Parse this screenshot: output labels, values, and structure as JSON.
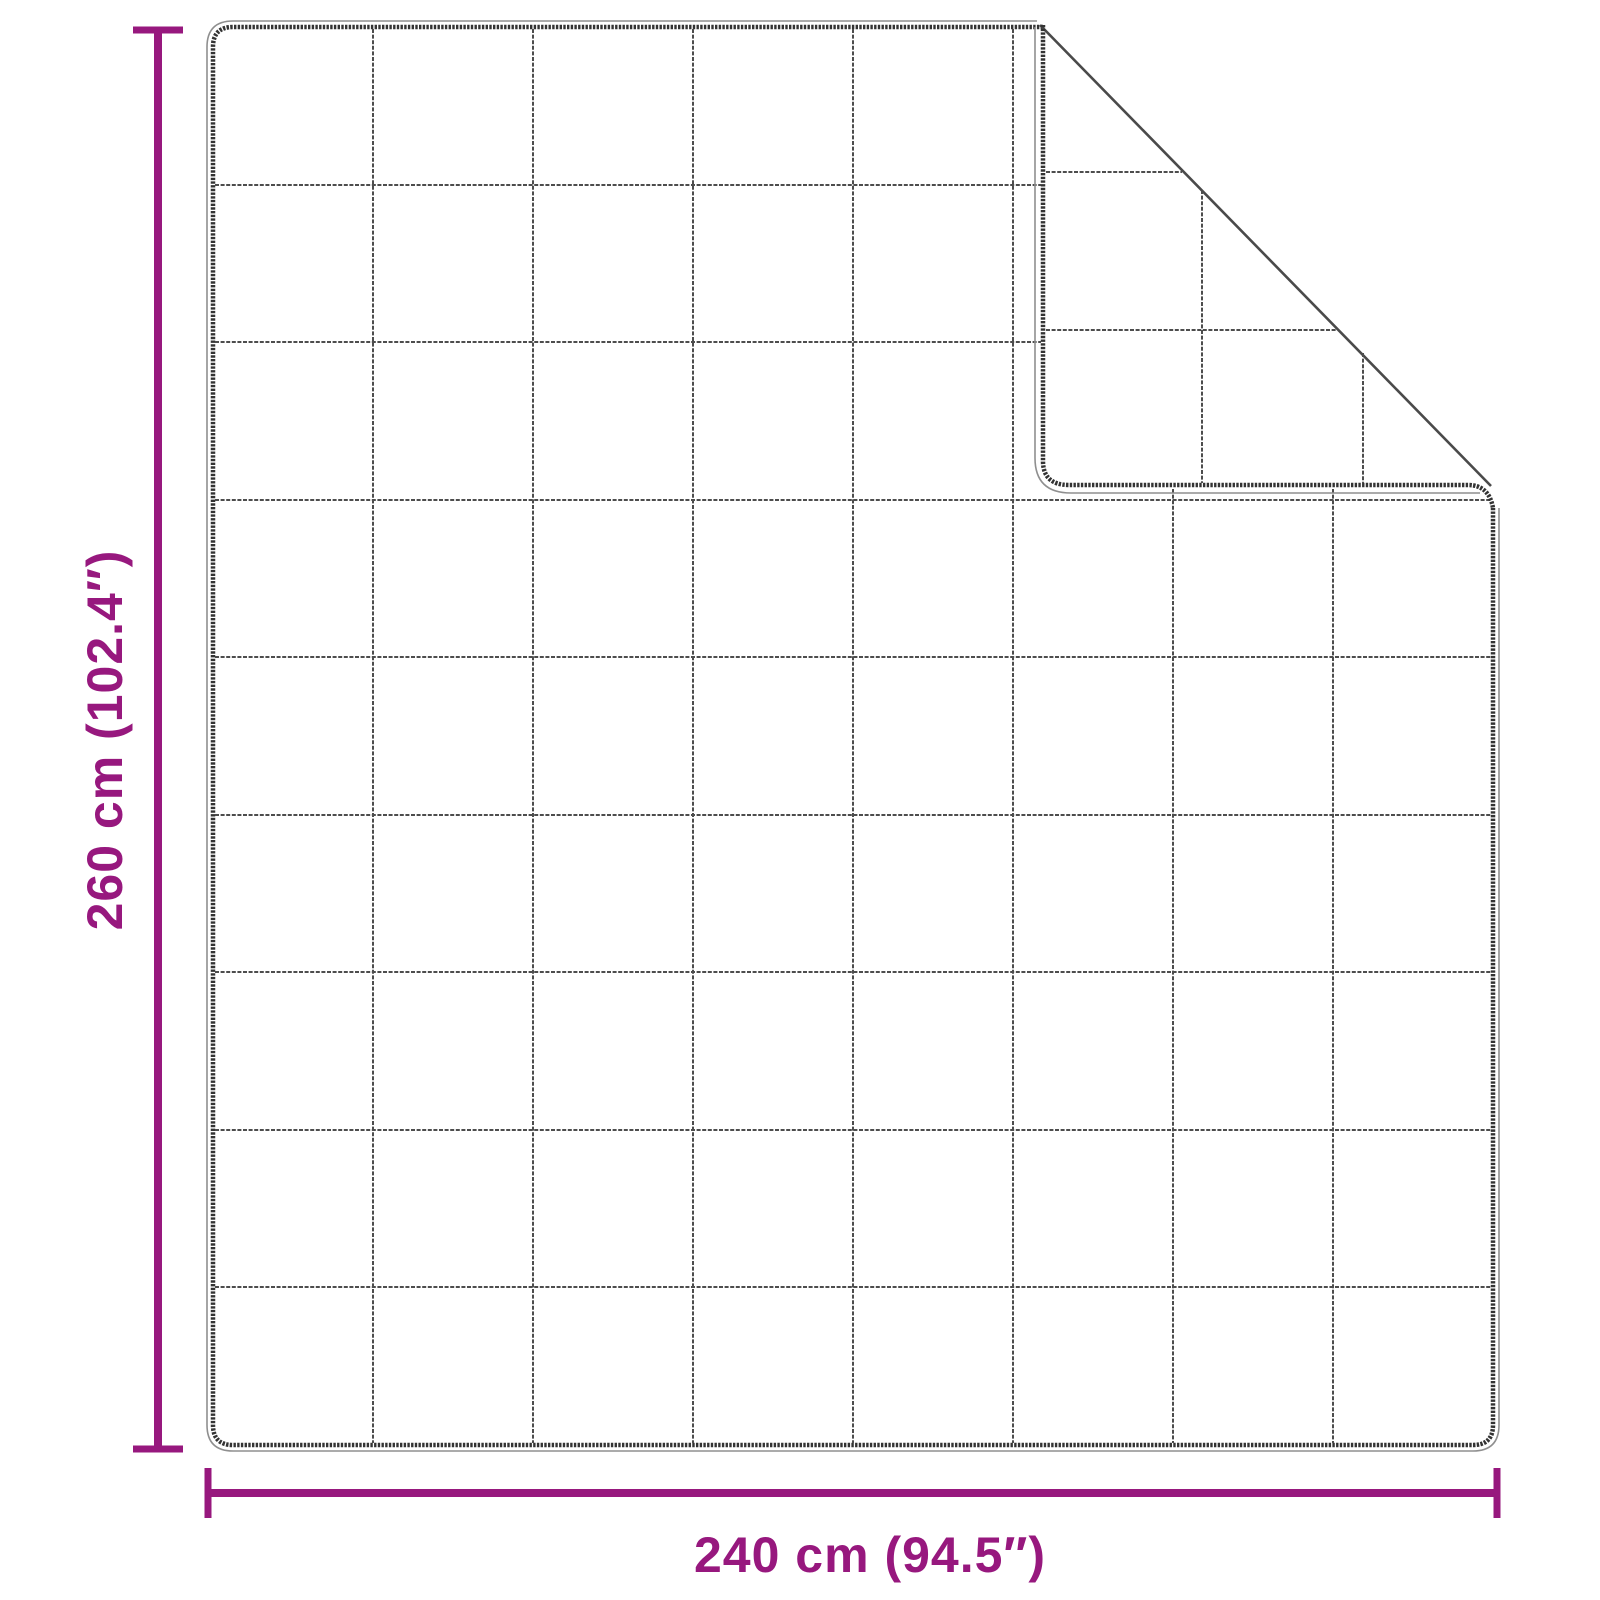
{
  "diagram": {
    "subject": "quilted-blanket-with-folded-corner",
    "vertical_dimension": {
      "label": "260 cm (102.4″)"
    },
    "horizontal_dimension": {
      "label": "240 cm (94.5″)"
    },
    "grid": {
      "columns": 8,
      "rows": 9
    },
    "colors": {
      "dimension_accent": "#97187E",
      "blanket_edge": "#333333",
      "grid_line": "#4D4D4D",
      "background": "#FFFFFF"
    }
  }
}
